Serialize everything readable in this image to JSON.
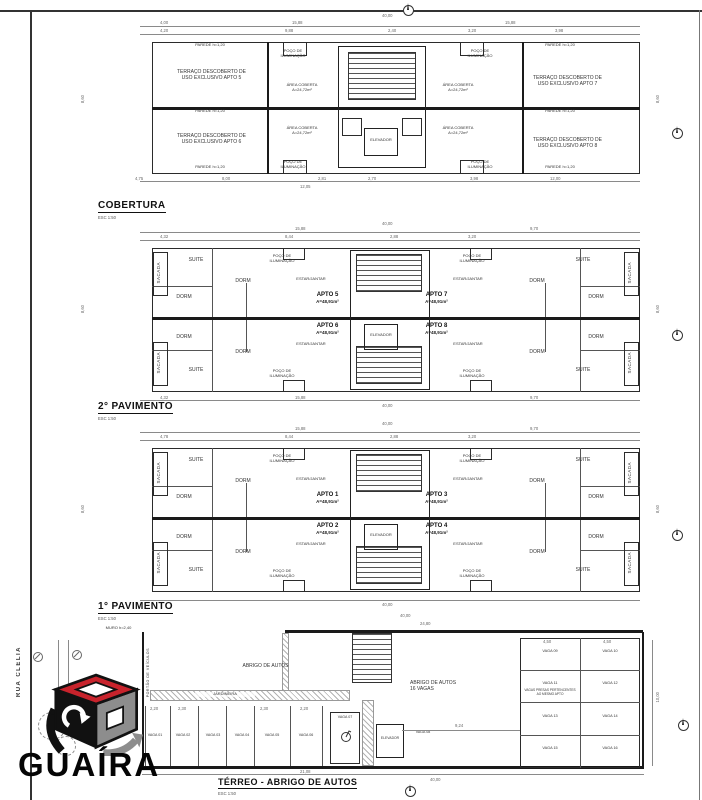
{
  "colors": {
    "paper": "#ffffff",
    "wall_ink": "#1a1a1a",
    "dim_ink": "#666666",
    "logo_red": "#c8232c",
    "logo_gray": "#8d8d8d",
    "logo_black": "#111111"
  },
  "street_label": "RUA CLELIA",
  "rooms": {
    "suite": "SUITE",
    "dorm": "DORM",
    "estar": "ESTAR/JANTAR",
    "sacada": "SACADA",
    "poco": "POÇO DE\nILUMINAÇÃO",
    "elevador": "ELEVADOR",
    "area_coberta": "ÁREA COBERTA\nA=24,72m²",
    "parede": "PAREDE h=1,20"
  },
  "plans": [
    {
      "title": "COBERTURA",
      "scale": "ESC 1:50",
      "terraces": [
        "TERRAÇO DESCOBERTO DE\nUSO EXCLUSIVO APTO 5",
        "TERRAÇO DESCOBERTO DE\nUSO EXCLUSIVO APTO 6",
        "TERRAÇO DESCOBERTO DE\nUSO EXCLUSIVO APTO 7",
        "TERRAÇO DESCOBERTO DE\nUSO EXCLUSIVO APTO 8"
      ],
      "dims": {
        "total": "40,00",
        "row1": [
          "4,00",
          "15,88",
          "15,88"
        ],
        "row2": [
          "4,20",
          "9,88",
          "2,40",
          "3,20",
          "3,98"
        ],
        "left": "8,60",
        "right": "8,60",
        "bottom": [
          "4,75",
          "8,00",
          "2,81",
          "2,70",
          "3,98",
          "12,00"
        ],
        "bottom2": "12,05"
      }
    },
    {
      "title": "2° PAVIMENTO",
      "scale": "ESC 1:50",
      "apartments": [
        {
          "name": "APTO 5",
          "area": "A=48,91m²"
        },
        {
          "name": "APTO 6",
          "area": "A=48,91m²"
        },
        {
          "name": "APTO 7",
          "area": "A=48,91m²"
        },
        {
          "name": "APTO 8",
          "area": "A=48,91m²"
        }
      ],
      "dims": {
        "total": "40,00",
        "row1": [
          "15,88",
          "9,70"
        ],
        "row2": [
          "4,32",
          "8,44",
          "2,88",
          "3,20"
        ],
        "left": "8,60",
        "right": "8,60",
        "bottom": [
          "4,32",
          "15,88",
          "9,70"
        ],
        "bottom2": "40,00"
      }
    },
    {
      "title": "1° PAVIMENTO",
      "scale": "ESC 1:50",
      "apartments": [
        {
          "name": "APTO 1",
          "area": "A=48,91m²"
        },
        {
          "name": "APTO 2",
          "area": "A=48,91m²"
        },
        {
          "name": "APTO 3",
          "area": "A=48,91m²"
        },
        {
          "name": "APTO 4",
          "area": "A=48,91m²"
        }
      ],
      "dims": {
        "total": "40,00",
        "row1": [
          "15,88",
          "9,70"
        ],
        "row2": [
          "4,78",
          "8,44",
          "2,88",
          "3,20"
        ],
        "left": "8,60",
        "right": "8,60",
        "bottom2": "40,00"
      }
    },
    {
      "title": "TÉRREO - ABRIGO DE AUTOS",
      "scale": "ESC 1:50",
      "labels": {
        "abrigo": "ABRIGO DE AUTOS",
        "abrigo_16": "ABRIGO DE AUTOS\n16 VAGAS",
        "jardineira": "JARDINEIRA",
        "muro": "MURO h=2,40",
        "portao": "PORTÃO DE VEÍCULOS",
        "nota": "VAGAS PRESAS PERTENCENTES\nAO MESMO APTO",
        "elevador": "ELEVADOR"
      },
      "vagas_row": [
        "VAGA 01",
        "VAGA 02",
        "VAGA 03",
        "VAGA 04",
        "VAGA 05",
        "VAGA 06",
        "VAGA 07",
        "VAGA 08"
      ],
      "vagas_grid": [
        "VAGA 09",
        "VAGA 10",
        "VAGA 11",
        "VAGA 12",
        "VAGA 13",
        "VAGA 14",
        "VAGA 15",
        "VAGA 16"
      ],
      "dims": {
        "total_top": "40,00",
        "top": "24,80",
        "right": "10,00",
        "span": "9,24",
        "bottom": "21,08",
        "total_bottom": "40,00",
        "cell": "4,50",
        "slot1": "2,20",
        "slot2": "2,30"
      }
    }
  ],
  "logo": {
    "wordmark": "GUAÍRA"
  }
}
